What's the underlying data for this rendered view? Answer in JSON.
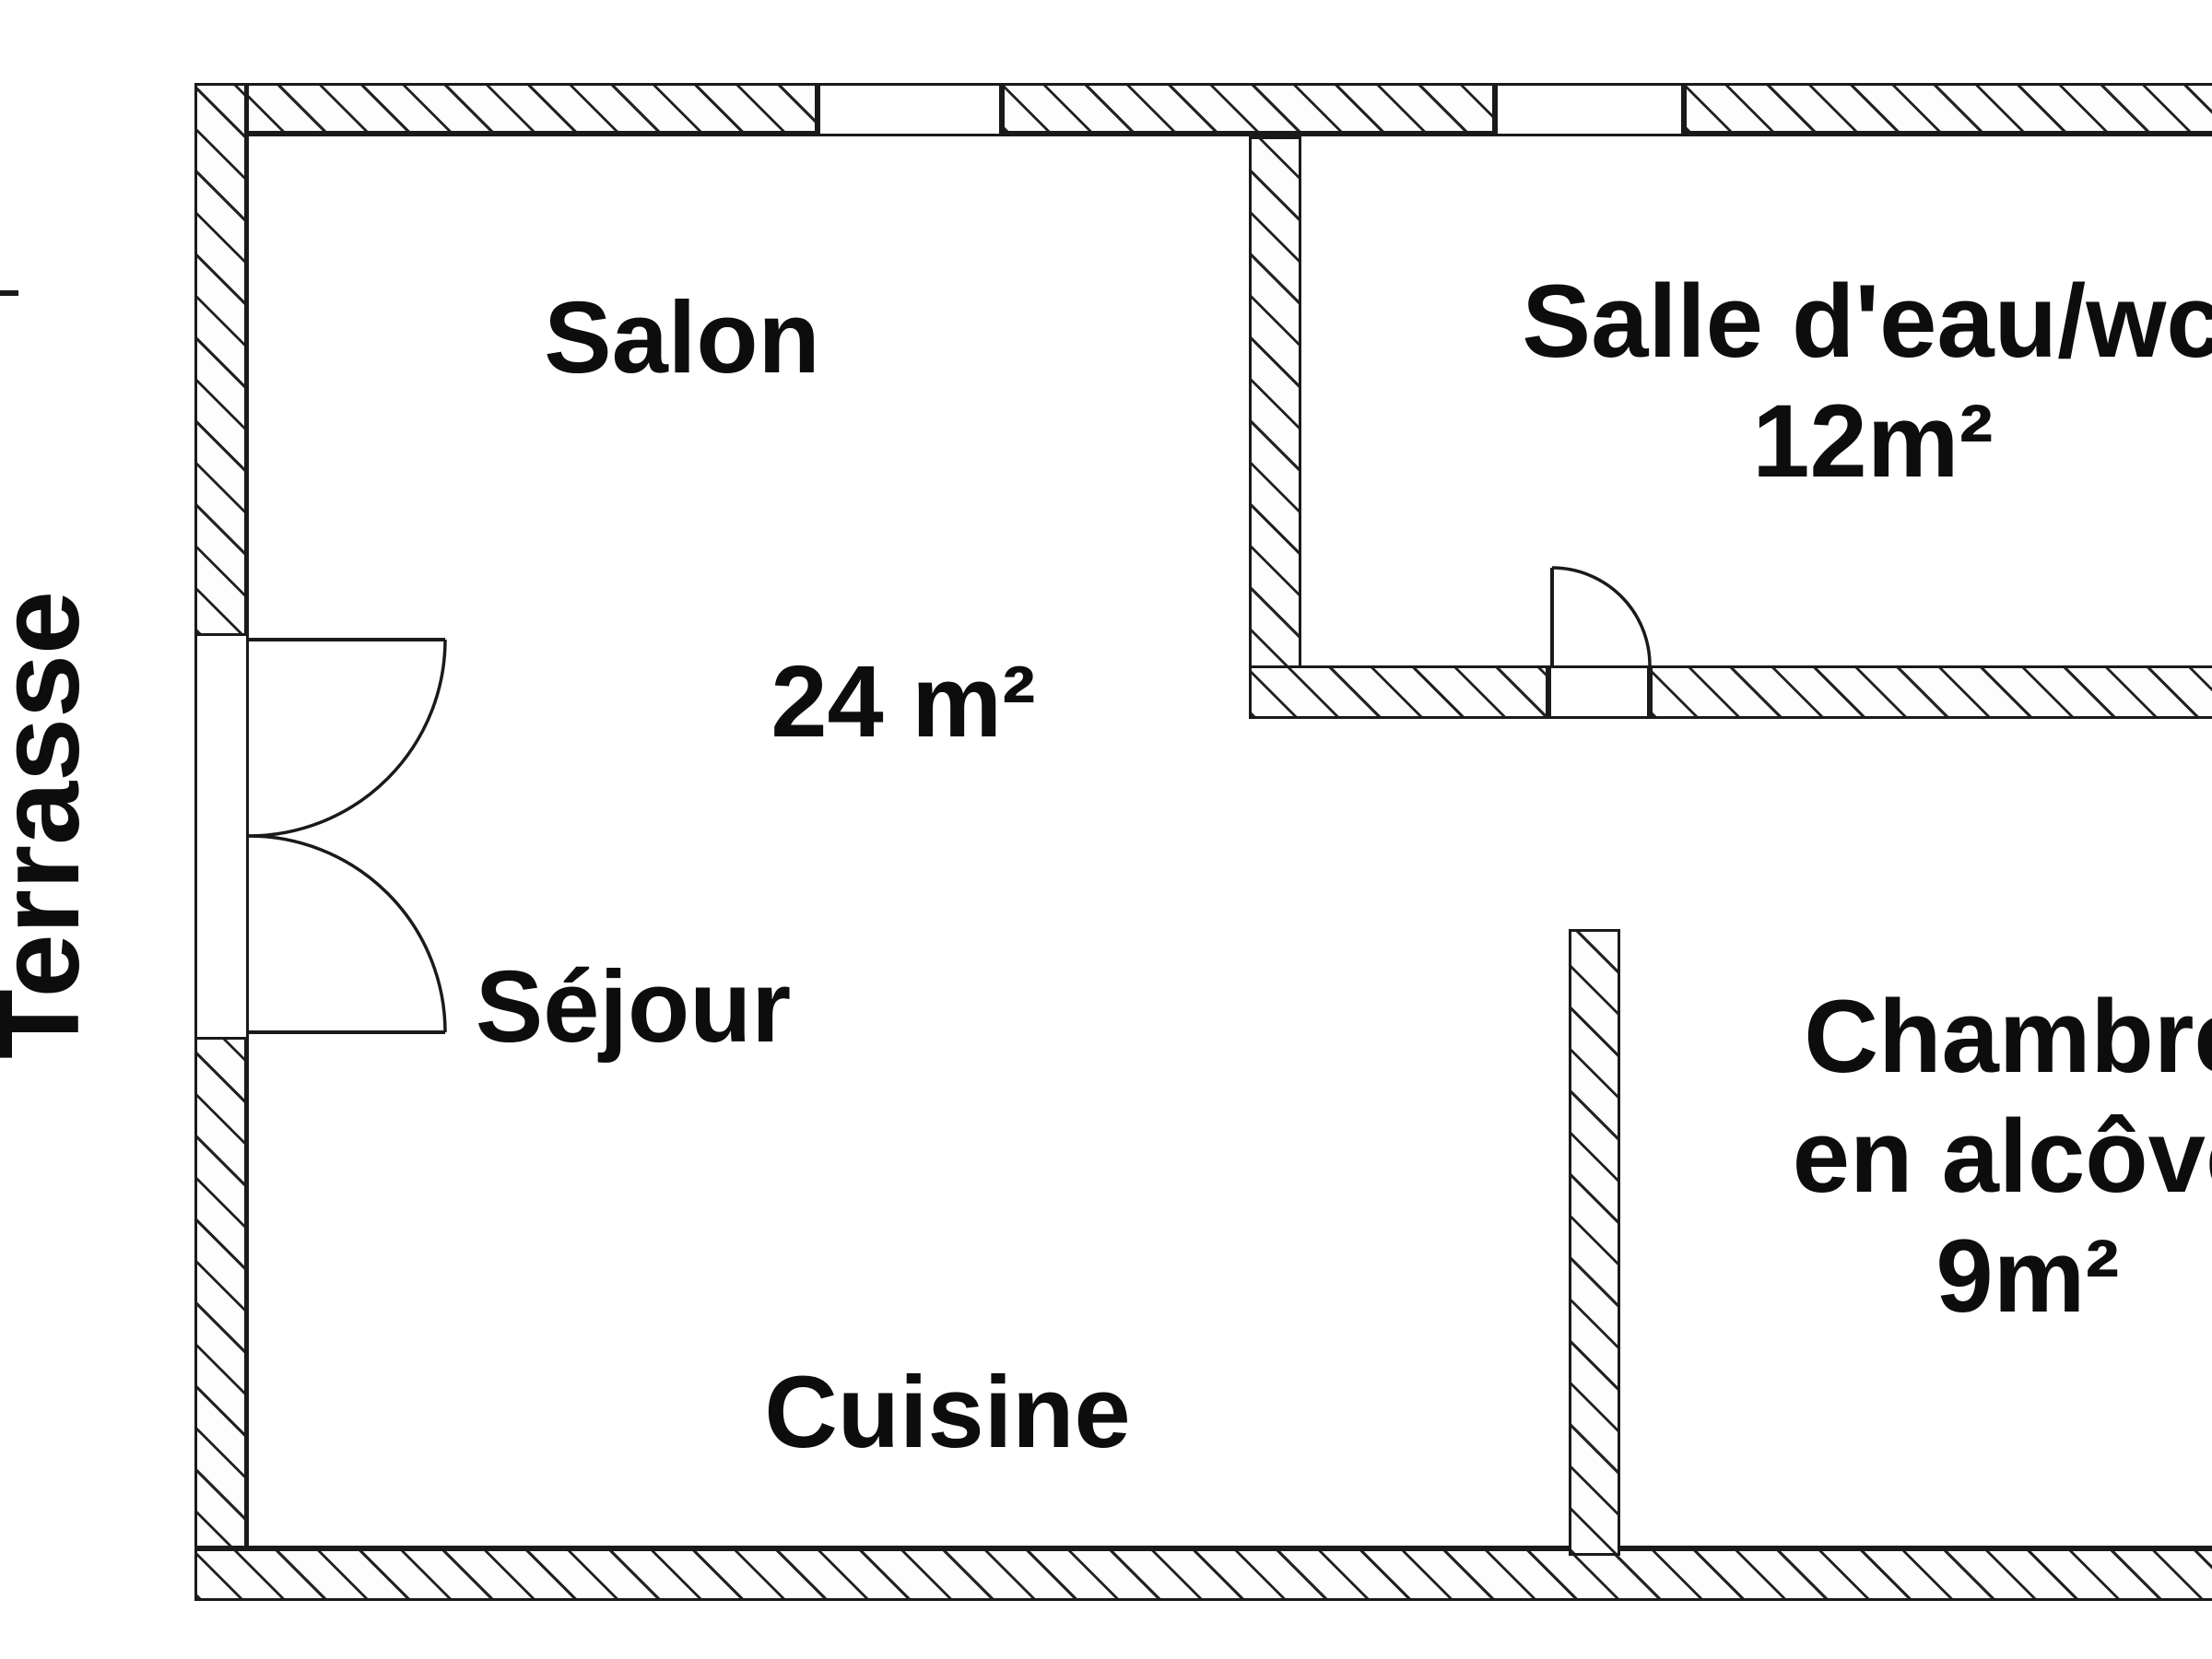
{
  "plan": {
    "title": "Apartment floor plan",
    "rooms": {
      "salon": {
        "label": "Salon",
        "area": "24 m²"
      },
      "sejour": {
        "label": "Séjour"
      },
      "cuisine": {
        "label": "Cuisine"
      },
      "salle_deau": {
        "label": "Salle d'eau/wc",
        "area": "12m²"
      },
      "chambre": {
        "label": "Chambre",
        "sublabel": "en alcôve",
        "area": "9m²"
      }
    },
    "outdoor": {
      "label": "Terrasse"
    },
    "features": {
      "double_door": "double French door between Terrasse and Séjour",
      "interior_door": "door into Salle d'eau/wc",
      "windows": 2
    }
  },
  "colors": {
    "background": "#ffffff",
    "line": "#1a1a1a",
    "text": "#0d0d0d"
  }
}
